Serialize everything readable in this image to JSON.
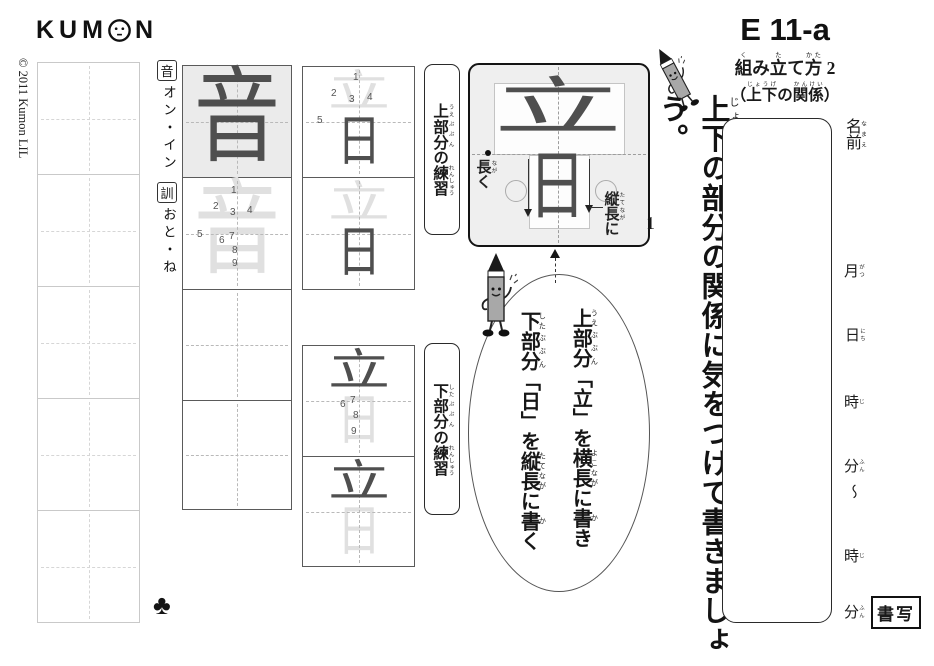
{
  "colors": {
    "ink": "#1a1a1a",
    "model_ink": "#4f4f4f",
    "trace": "#e0e0e0",
    "model_cell_bg": "#ebebeb"
  },
  "brand": {
    "logo_left": "KUM",
    "logo_right": "N",
    "copyright": "© 2011 Kumon LIL"
  },
  "header": {
    "code": "E 11-a",
    "title": [
      {
        "b": "組",
        "r": "く"
      },
      {
        "b": "み"
      },
      {
        "b": "立",
        "r": "た"
      },
      {
        "b": "て"
      },
      {
        "b": "方",
        "r": "かた"
      },
      {
        "b": " 2"
      }
    ],
    "subtitle": [
      {
        "b": "（"
      },
      {
        "b": "上下",
        "r": "じょうげ"
      },
      {
        "b": "の"
      },
      {
        "b": "関係",
        "r": "かんけい"
      },
      {
        "b": "）"
      }
    ]
  },
  "instruction": [
    {
      "b": "上下",
      "r": "じょうげ"
    },
    {
      "b": "の"
    },
    {
      "b": "部分",
      "r": "ぶぶん"
    },
    {
      "b": "の"
    },
    {
      "b": "関係",
      "r": "かんけい"
    },
    {
      "b": "に"
    },
    {
      "b": "気",
      "r": "き"
    },
    {
      "b": "をつけて"
    },
    {
      "b": "書",
      "r": "か"
    },
    {
      "b": "きましょう。"
    }
  ],
  "readings": {
    "on_marker": "音",
    "on": "オン・イン",
    "kun_marker": "訓",
    "kun": "おと・ね"
  },
  "kanji": {
    "full": "音",
    "upper": "立",
    "lower": "日"
  },
  "stroke_numbers": {
    "upper": [
      "1",
      "2",
      "3",
      "4",
      "5"
    ],
    "lower": [
      "6",
      "7",
      "8",
      "9"
    ]
  },
  "practice_labels": {
    "upper": [
      {
        "b": "上",
        "r": "うえ"
      },
      {
        "b": "部分",
        "r": "ぶぶん"
      },
      {
        "b": "の"
      },
      {
        "b": "練習",
        "r": "れんしゅう"
      }
    ],
    "lower": [
      {
        "b": "下",
        "r": "した"
      },
      {
        "b": "部分",
        "r": "ぶぶん"
      },
      {
        "b": "の"
      },
      {
        "b": "練習",
        "r": "れんしゅう"
      }
    ]
  },
  "example": {
    "number": "1",
    "nagaku": [
      {
        "b": "長",
        "r": "なが"
      },
      {
        "b": "く"
      }
    ],
    "tatenaga": [
      {
        "b": "縦",
        "r": "たて"
      },
      {
        "b": "長",
        "r": "なが"
      },
      {
        "b": "に"
      }
    ]
  },
  "bubble": {
    "upper_line": [
      {
        "b": "上",
        "r": "うえ"
      },
      {
        "b": "部分",
        "r": "ぶぶん"
      },
      {
        "b": "「立」を"
      },
      {
        "b": "横長",
        "r": "よこなが"
      },
      {
        "b": "に"
      },
      {
        "b": "書",
        "r": "か"
      },
      {
        "b": "き"
      }
    ],
    "lower_line": [
      {
        "b": "下",
        "r": "した"
      },
      {
        "b": "部分",
        "r": "ぶぶん"
      },
      {
        "b": "「日」を"
      },
      {
        "b": "縦長",
        "r": "たてなが"
      },
      {
        "b": "に"
      },
      {
        "b": "書",
        "r": "か"
      },
      {
        "b": "く"
      }
    ]
  },
  "name_panel": {
    "name": [
      {
        "b": "名前",
        "r": "なまえ"
      }
    ],
    "month": [
      {
        "b": "月",
        "r": "がつ"
      }
    ],
    "day": [
      {
        "b": "日",
        "r": "にち"
      }
    ],
    "hour_start": [
      {
        "b": "時",
        "r": "じ"
      }
    ],
    "minute_start": [
      {
        "b": "分",
        "r": "ふん"
      }
    ],
    "tilde": "～",
    "hour_end": [
      {
        "b": "時",
        "r": "じ"
      }
    ],
    "minute_end": [
      {
        "b": "分",
        "r": "ふん"
      }
    ],
    "subject": "書写"
  },
  "footer": {
    "suit": "♣"
  }
}
